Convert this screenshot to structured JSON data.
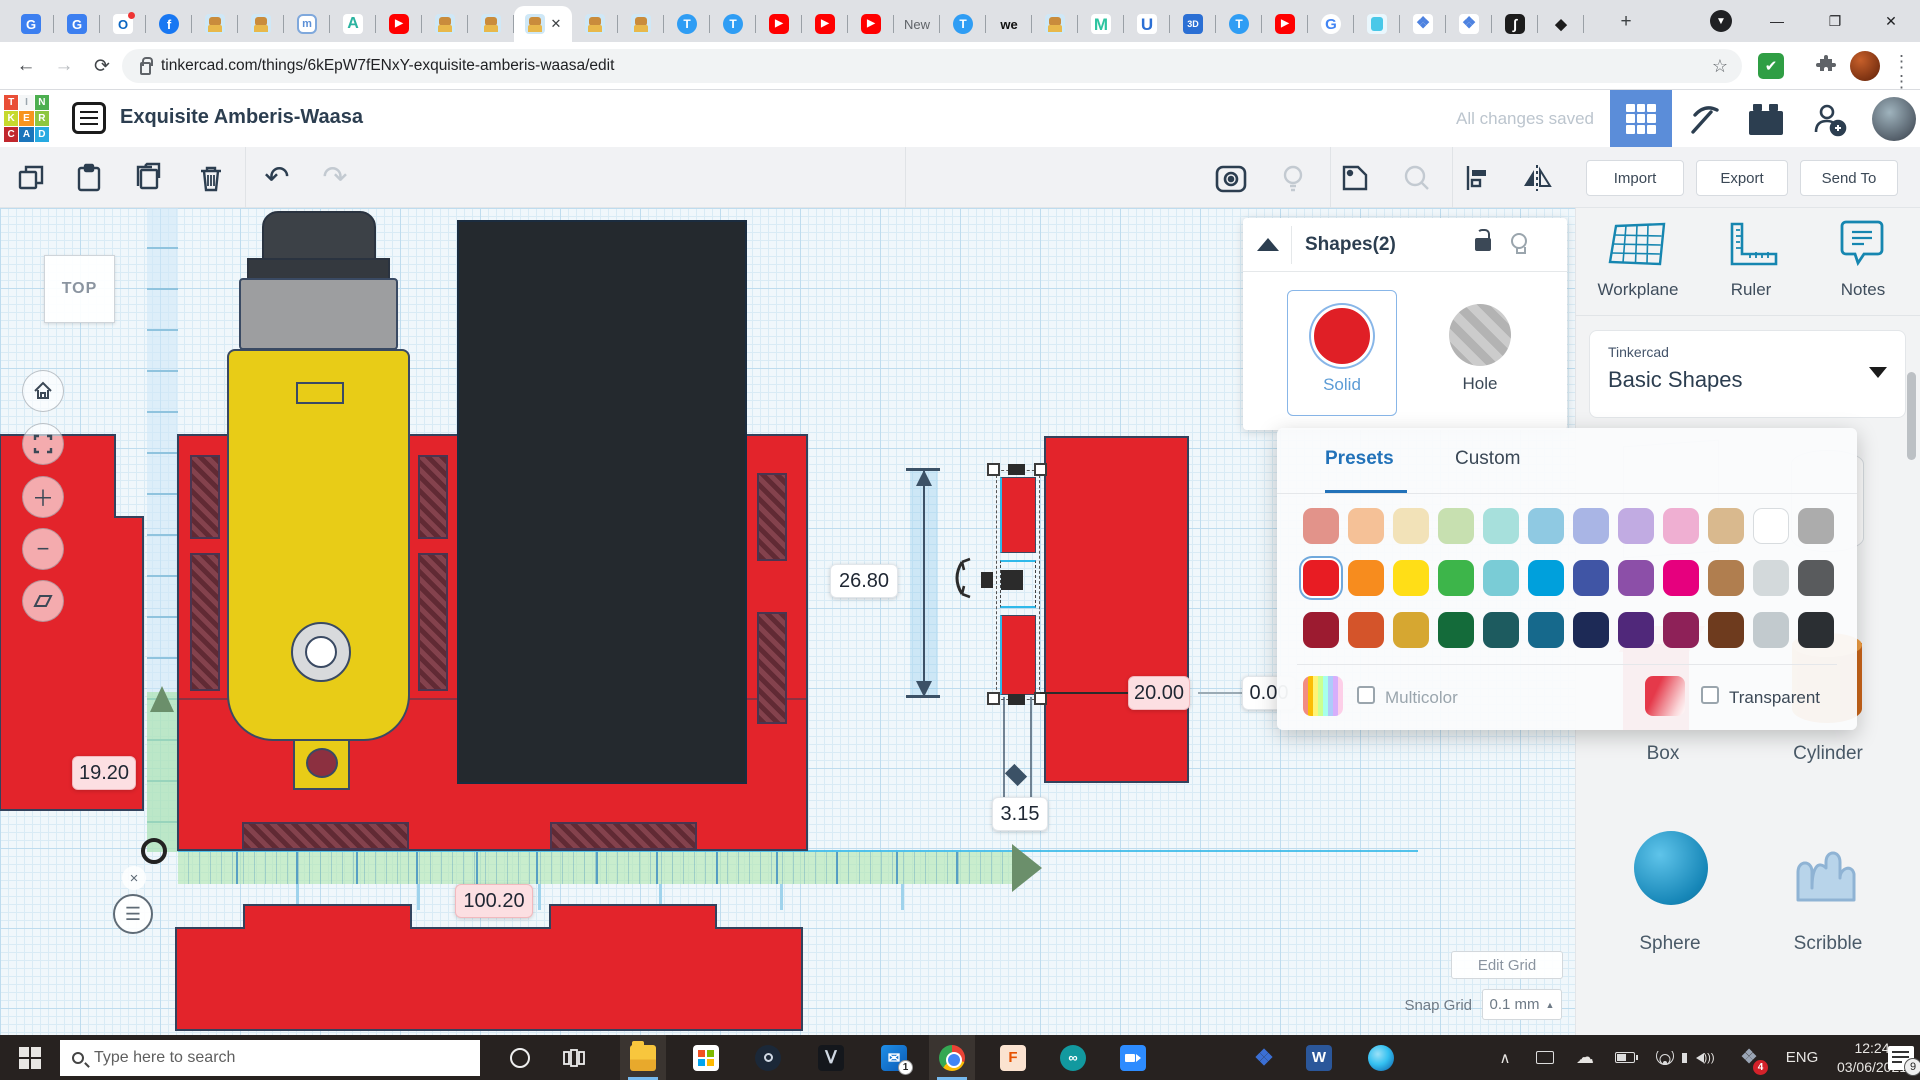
{
  "browser": {
    "url": "tinkercad.com/things/6kEpW7fENxY-exquisite-amberis-waasa/edit",
    "active_tab_index": 11,
    "tabs": [
      {
        "icon": "translate"
      },
      {
        "icon": "translate"
      },
      {
        "icon": "outlook"
      },
      {
        "icon": "facebook"
      },
      {
        "icon": "robot"
      },
      {
        "icon": "robot"
      },
      {
        "icon": "hexm"
      },
      {
        "icon": "autodesk"
      },
      {
        "icon": "youtube"
      },
      {
        "icon": "robot"
      },
      {
        "icon": "robot"
      },
      {
        "icon": "robot"
      },
      {
        "icon": "robot"
      },
      {
        "icon": "robot"
      },
      {
        "icon": "tinkercad"
      },
      {
        "icon": "tinkercad"
      },
      {
        "icon": "youtube"
      },
      {
        "icon": "youtube"
      },
      {
        "icon": "youtube"
      },
      {
        "icon": "text",
        "label": "New"
      },
      {
        "icon": "tinkercad"
      },
      {
        "icon": "text-bold",
        "label": "we"
      },
      {
        "icon": "robot"
      },
      {
        "icon": "m",
        "label": "M"
      },
      {
        "icon": "u",
        "label": "U"
      },
      {
        "icon": "threed",
        "label": "3D"
      },
      {
        "icon": "tinkercad"
      },
      {
        "icon": "youtube"
      },
      {
        "icon": "google",
        "label": "G"
      },
      {
        "icon": "robotcyan"
      },
      {
        "icon": "book"
      },
      {
        "icon": "book"
      },
      {
        "icon": "integral",
        "label": "∫"
      },
      {
        "icon": "inkscape",
        "label": "◆"
      }
    ]
  },
  "header": {
    "title": "Exquisite Amberis-Waasa",
    "status": "All changes saved"
  },
  "toolbar": {
    "import_label": "Import",
    "export_label": "Export",
    "sendto_label": "Send To"
  },
  "canvas": {
    "view_label": "TOP",
    "dim_height": "26.80",
    "dim_width": "20.00",
    "dim_zero": "0.00",
    "dim_gap": "3.15",
    "dim_left": "19.20",
    "dim_bottom": "100.20",
    "edit_grid_label": "Edit Grid",
    "snap_grid_label": "Snap Grid",
    "snap_grid_value": "0.1 mm"
  },
  "shapes_panel": {
    "title": "Shapes(2)",
    "solid_label": "Solid",
    "hole_label": "Hole"
  },
  "color_panel": {
    "tab_presets": "Presets",
    "tab_custom": "Custom",
    "multicolor_label": "Multicolor",
    "transparent_label": "Transparent",
    "selected_index": 12,
    "swatches": [
      "#E2938A",
      "#F5C197",
      "#F2E2B8",
      "#C7E0B0",
      "#A7E0DC",
      "#8FC9E2",
      "#A9B5E5",
      "#C1ABE2",
      "#EFAFD2",
      "#D9B98E",
      "#FFFFFF",
      "#ACACAC",
      "#E81C23",
      "#F78C1E",
      "#FFDE17",
      "#3DB54A",
      "#7ACCD6",
      "#00A0DC",
      "#4055A5",
      "#8C4FA8",
      "#E6007E",
      "#B07E4F",
      "#D3D9DB",
      "#595B5D",
      "#9C1B30",
      "#D4542A",
      "#D6A731",
      "#146B3A",
      "#1D5B5F",
      "#16698C",
      "#1D2A56",
      "#50287A",
      "#8E2158",
      "#6E3B1E",
      "#C2CACE",
      "#2B2F33"
    ]
  },
  "sidebar": {
    "tools": [
      "Workplane",
      "Ruler",
      "Notes"
    ],
    "library_brand": "Tinkercad",
    "library_name": "Basic Shapes",
    "gallery": [
      "Box",
      "Cylinder",
      "Sphere",
      "Scribble"
    ]
  },
  "taskbar": {
    "search_placeholder": "Type here to search",
    "lang": "ENG",
    "time": "12:24",
    "date": "03/06/2021",
    "mail_badge": "1",
    "dropbox_badge": "4",
    "notif_badge": "9"
  },
  "logo": {
    "letters": [
      "T",
      "I",
      "N",
      "K",
      "E",
      "R",
      "C",
      "A",
      "D"
    ],
    "colors": [
      "#E94E37",
      "#F4F6F7",
      "#4CAF50",
      "#C6D92D",
      "#F7941D",
      "#8DC63F",
      "#C1272D",
      "#1B75BB",
      "#27AAE1"
    ],
    "letter_colors": [
      "#fff",
      "#9aa5ad",
      "#fff",
      "#fff",
      "#fff",
      "#fff",
      "#fff",
      "#fff",
      "#fff"
    ]
  }
}
